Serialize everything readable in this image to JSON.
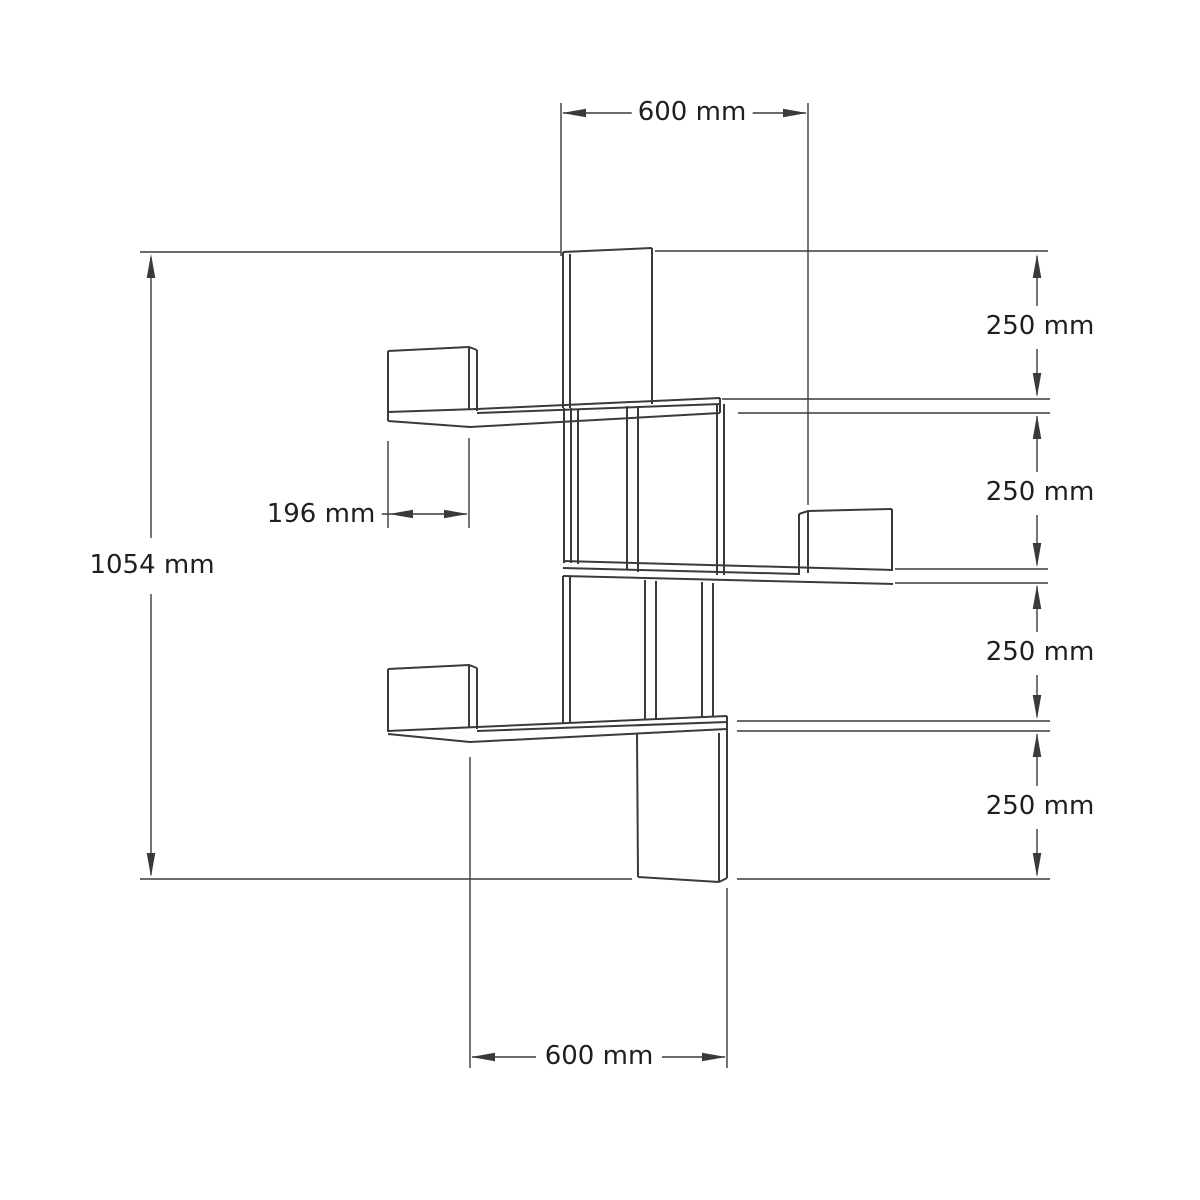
{
  "drawing": {
    "name": "corner-wall-shelf-dimension-drawing",
    "unit": "mm",
    "dimensions": {
      "top_width": {
        "label": "600 mm",
        "value": 600
      },
      "bottom_width": {
        "label": "600 mm",
        "value": 600
      },
      "total_height": {
        "label": "1054 mm",
        "value": 1054
      },
      "shelf_depth": {
        "label": "196 mm",
        "value": 196
      },
      "shelf_spacings": [
        {
          "label": "250 mm",
          "value": 250
        },
        {
          "label": "250 mm",
          "value": 250
        },
        {
          "label": "250 mm",
          "value": 250
        },
        {
          "label": "250 mm",
          "value": 250
        }
      ]
    },
    "colors": {
      "background": "#ffffff",
      "line": "#3a3a3a",
      "text": "#1f1f1f"
    }
  }
}
